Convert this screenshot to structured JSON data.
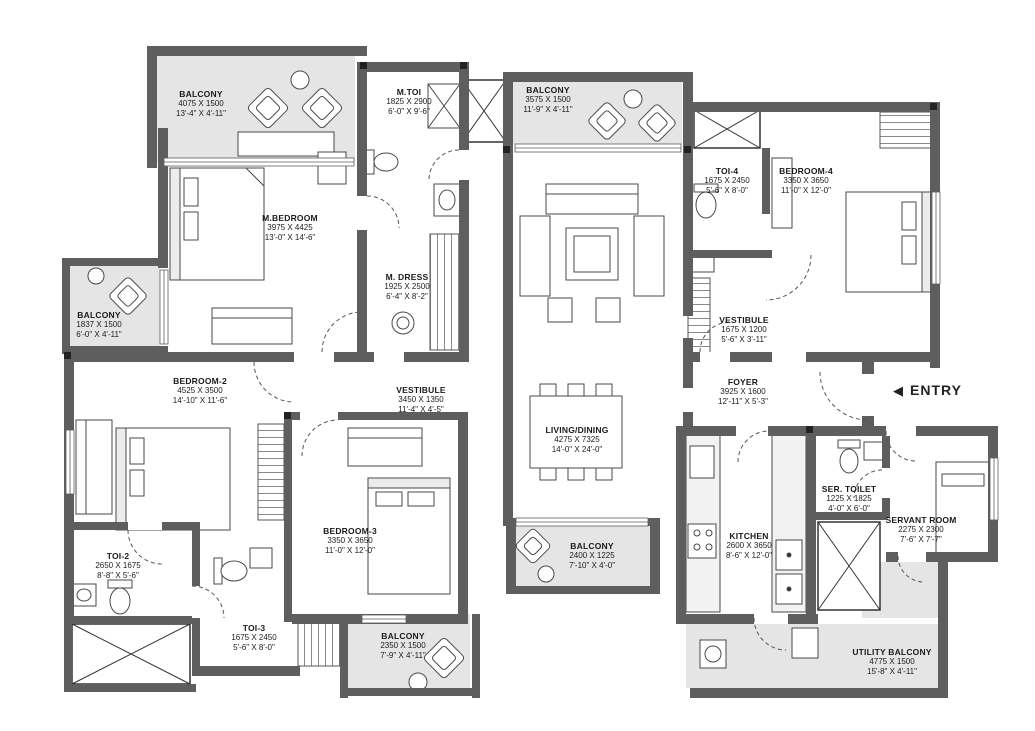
{
  "plan": {
    "entry": {
      "arrow": "◀",
      "label": "ENTRY"
    },
    "rooms": [
      {
        "id": "balcony-top-left",
        "name": "BALCONY",
        "mm": "4075 X 1500",
        "ft": "13'-4\" X 4'-11\""
      },
      {
        "id": "m-toi",
        "name": "M.TOI",
        "mm": "1825 X 2900",
        "ft": "6'-0\" X 9'-6\""
      },
      {
        "id": "balcony-top",
        "name": "BALCONY",
        "mm": "3575 X 1500",
        "ft": "11'-9\" X 4'-11\""
      },
      {
        "id": "toi-4",
        "name": "TOI-4",
        "mm": "1675 X 2450",
        "ft": "5'-6\" X 8'-0\""
      },
      {
        "id": "bedroom-4",
        "name": "BEDROOM-4",
        "mm": "3350 X 3650",
        "ft": "11'-0\" X 12'-0\""
      },
      {
        "id": "m-bedroom",
        "name": "M.BEDROOM",
        "mm": "3975 X 4425",
        "ft": "13'-0\" X 14'-6\""
      },
      {
        "id": "m-dress",
        "name": "M. DRESS",
        "mm": "1925 X 2500",
        "ft": "6'-4\" X 8'-2\""
      },
      {
        "id": "balcony-left",
        "name": "BALCONY",
        "mm": "1837 X 1500",
        "ft": "6'-0\" X 4'-11\""
      },
      {
        "id": "vestibule-right",
        "name": "VESTIBULE",
        "mm": "1675 X 1200",
        "ft": "5'-6\" X 3'-11\""
      },
      {
        "id": "bedroom-2",
        "name": "BEDROOM-2",
        "mm": "4525 X 3500",
        "ft": "14'-10\" X 11'-6\""
      },
      {
        "id": "vestibule-mid",
        "name": "VESTIBULE",
        "mm": "3450 X 1350",
        "ft": "11'-4\" X 4'-5\""
      },
      {
        "id": "foyer",
        "name": "FOYER",
        "mm": "3925 X 1600",
        "ft": "12'-11\" X 5'-3\""
      },
      {
        "id": "living-dining",
        "name": "LIVING/DINING",
        "mm": "4275 X 7325",
        "ft": "14'-0\" X 24'-0\""
      },
      {
        "id": "bedroom-3",
        "name": "BEDROOM-3",
        "mm": "3350 X 3650",
        "ft": "11'-0\" X 12'-0\""
      },
      {
        "id": "kitchen",
        "name": "KITCHEN",
        "mm": "2600 X 3650",
        "ft": "8'-6\" X 12'-0\""
      },
      {
        "id": "ser-toilet",
        "name": "SER. TOILET",
        "mm": "1225 X 1825",
        "ft": "4'-0\" X 6'-0\""
      },
      {
        "id": "servant-room",
        "name": "SERVANT ROOM",
        "mm": "2275 X 2300",
        "ft": "7'-6\" X 7'-7\""
      },
      {
        "id": "toi-2",
        "name": "TOI-2",
        "mm": "2650 X 1675",
        "ft": "8'-8\" X 5'-6\""
      },
      {
        "id": "balcony-mid",
        "name": "BALCONY",
        "mm": "2400 X 1225",
        "ft": "7'-10\" X 4'-0\""
      },
      {
        "id": "toi-3",
        "name": "TOI-3",
        "mm": "1675 X 2450",
        "ft": "5'-6\" X 8'-0\""
      },
      {
        "id": "balcony-bottom",
        "name": "BALCONY",
        "mm": "2350 X 1500",
        "ft": "7'-9\" X 4'-11\""
      },
      {
        "id": "utility-balcony",
        "name": "UTILITY BALCONY",
        "mm": "4775 X 1500",
        "ft": "15'-8\" X 4'-11\""
      }
    ]
  }
}
